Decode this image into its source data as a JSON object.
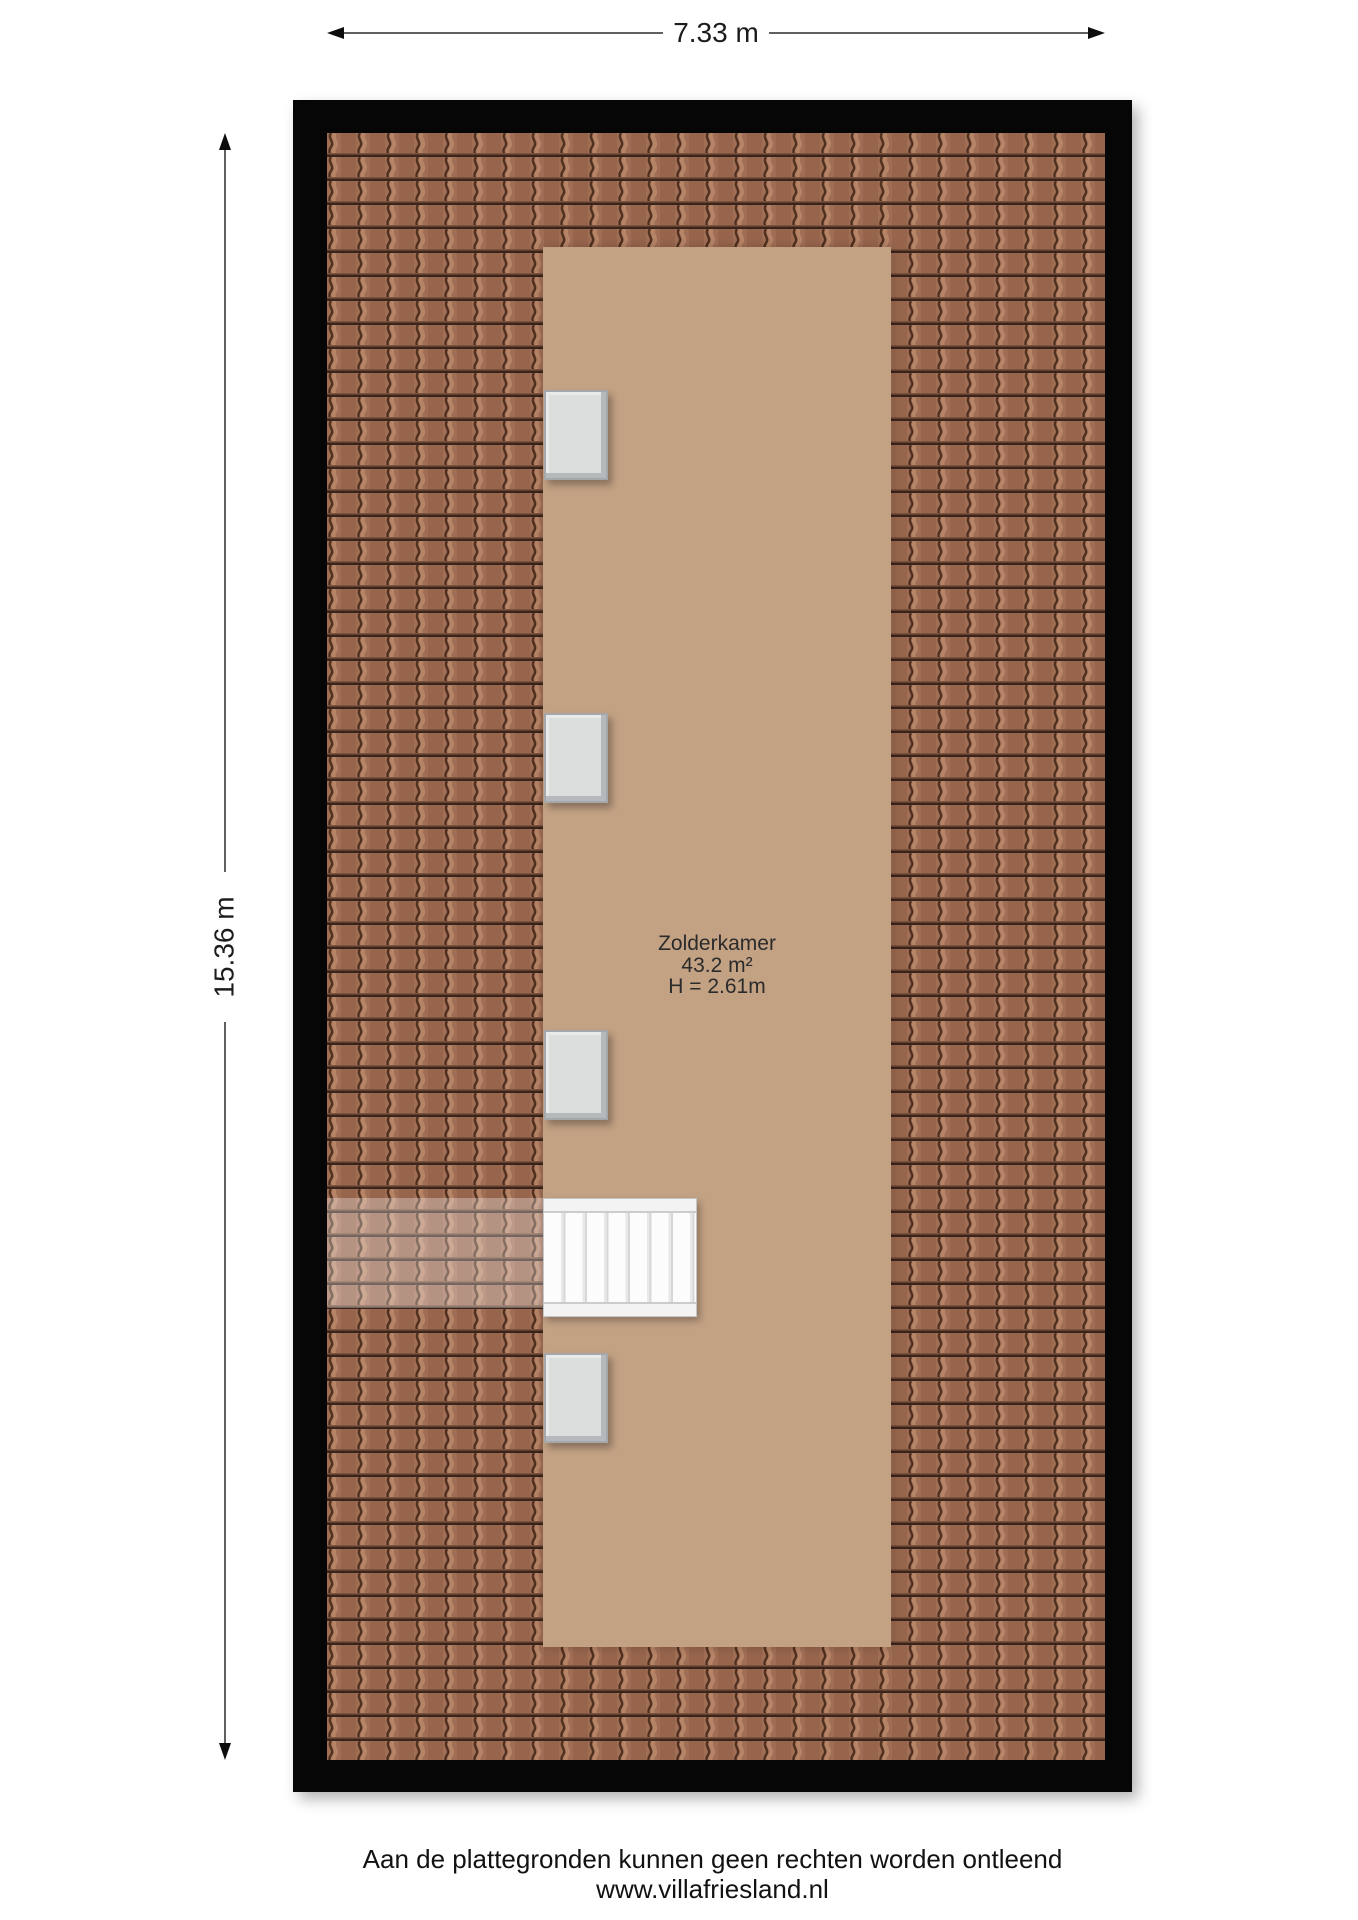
{
  "dimensions": {
    "width_label": "7.33 m",
    "height_label": "15.36 m"
  },
  "room": {
    "name": "Zolderkamer",
    "area": "43.2 m²",
    "ceiling_height": "H = 2.61m"
  },
  "footer": {
    "disclaimer": "Aan de plattegronden kunnen geen rechten worden ontleend",
    "website": "www.villafriesland.nl"
  },
  "features": {
    "windows_count": 4,
    "staircase_steps": 7
  },
  "colors": {
    "wall_outline": "#060606",
    "roof_tile_base": "#a06e55",
    "roof_tile_shade": "#96654c",
    "roof_tile_highlight": "#b8866a",
    "roof_tile_groove": "#50301f",
    "roof_tile_row_line": "#39231a",
    "floor": "#c3a284",
    "window_fill": "#dcdddd",
    "stairs_fill": "#f7f7f7",
    "dimension_line": "#606060",
    "text": "#1c1c1c"
  }
}
